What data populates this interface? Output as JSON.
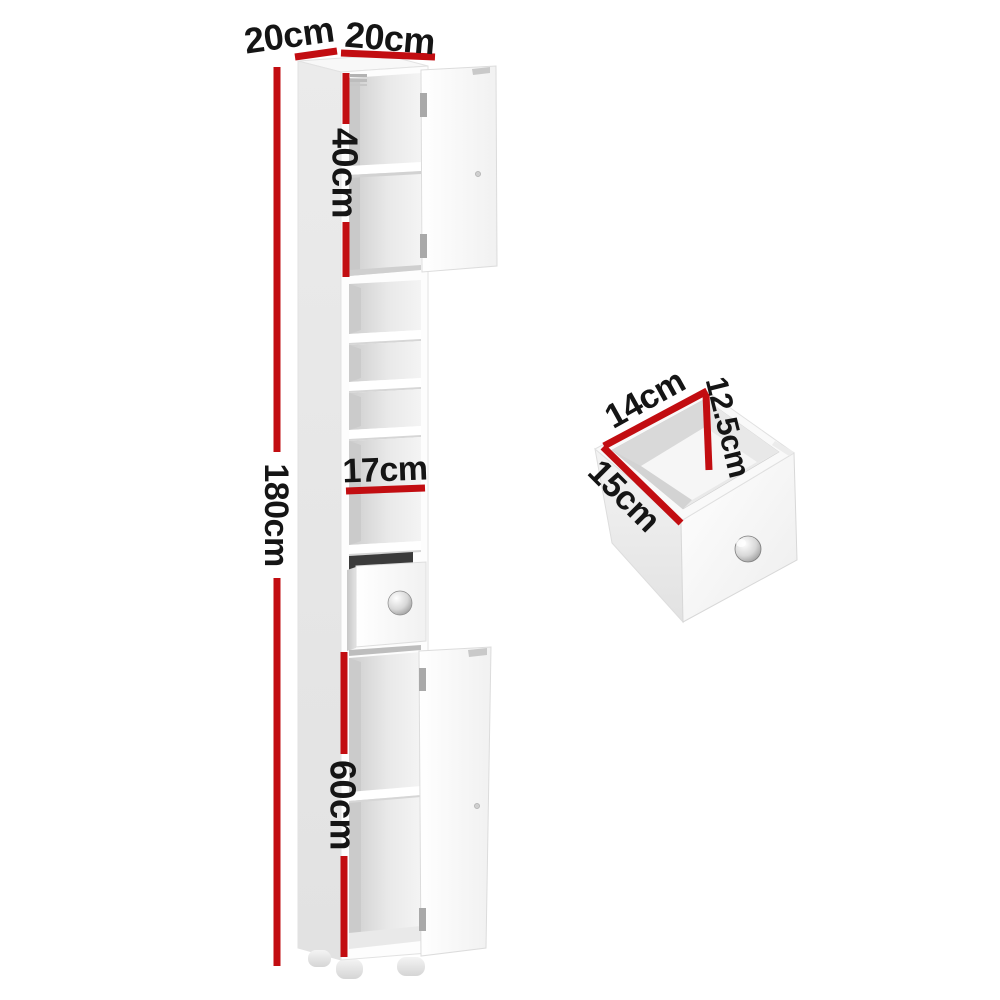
{
  "title": "Tall narrow bathroom storage cabinet dimension diagram",
  "accent_color": "#c20d11",
  "text_color": "#151515",
  "dimensions": {
    "top_depth": "20cm",
    "top_width": "20cm",
    "upper_door_height": "40cm",
    "overall_height": "180cm",
    "middle_shelf_height": "17cm",
    "lower_door_height": "60cm",
    "drawer_inner_width": "14cm",
    "drawer_inner_height": "12.5cm",
    "drawer_inner_depth": "15cm"
  }
}
